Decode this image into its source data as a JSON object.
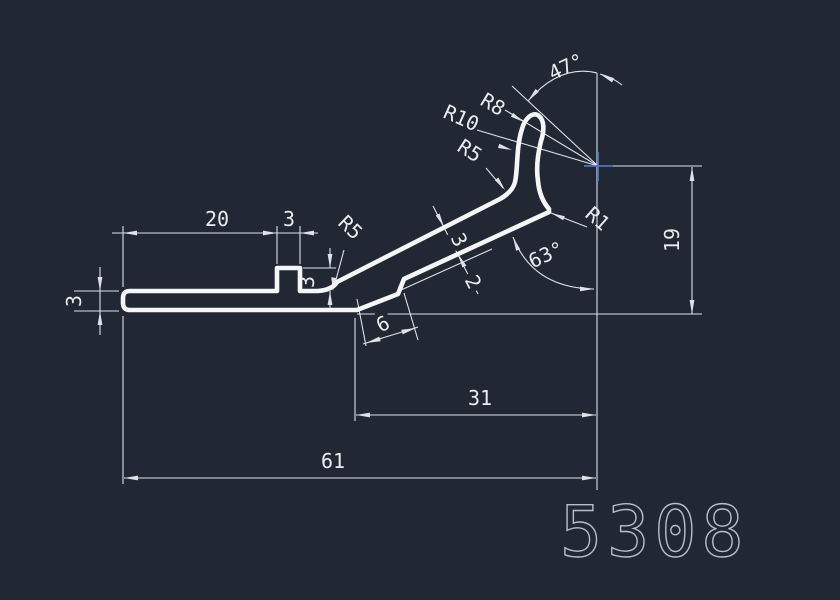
{
  "drawing": {
    "part_number": "5308",
    "linear_dimensions": {
      "bar_left_length": "20",
      "bump_width": "3",
      "bump_height": "3",
      "bar_thickness": "3",
      "arm_thickness": "3",
      "lip_thickness": "2",
      "lip_length": "6",
      "hook_horizontal_span": "31",
      "overall_length": "61",
      "hook_height": "19"
    },
    "angular_dimensions": {
      "tip_angle": "47°",
      "arm_to_vertical_angle": "63°"
    },
    "radius_labels": {
      "tip_outer": "R8",
      "neck": "R10",
      "finger_base": "R5",
      "root_fillet": "R5",
      "notch": "R1"
    }
  },
  "colors": {
    "background": "#212833",
    "profile_line": "#f4f6f9",
    "dimension_line": "#dde2e9",
    "cursor_cross": "#4a74c4",
    "part_number_text": "#b9bfc9"
  }
}
